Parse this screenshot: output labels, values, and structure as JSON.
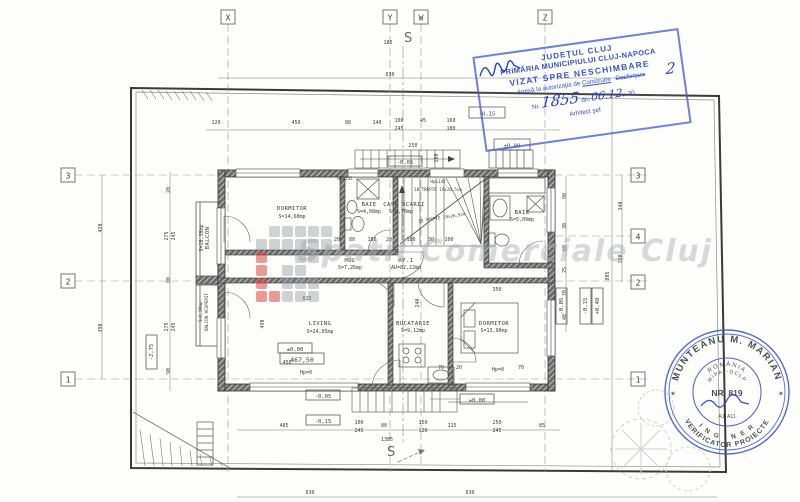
{
  "colors": {
    "ink": "#3c3c3c",
    "wall": "#2f2f2f",
    "stamp_blue": "#3b55c8",
    "watermark_grey": "#a8abaf",
    "watermark_red": "#d8483e",
    "grid_dash": "#9a9a9a"
  },
  "grid": {
    "top": [
      "X",
      "Y",
      "W",
      "Z"
    ],
    "left": [
      "3",
      "2",
      "1"
    ],
    "right": [
      "3",
      "4",
      "2",
      "1"
    ],
    "section_top": "S",
    "section_bottom": "S"
  },
  "rooms": {
    "dormitor1": {
      "name": "DORMITOR",
      "area": "S=14,60mp"
    },
    "baie1": {
      "name": "BAIE",
      "area": "S=4,08mp"
    },
    "casa_scarii": {
      "name": "CASA SCARII",
      "area": "S=8,70mp"
    },
    "baie2": {
      "name": "BAIE",
      "area": "S=5,09mp"
    },
    "hol": {
      "name": "HOL",
      "area": "S=7,26mp"
    },
    "ap1": {
      "name": "AP.1",
      "area": "AU=82,22mp"
    },
    "living": {
      "name": "LIVING",
      "area": "S=24,05mp"
    },
    "bucatarie": {
      "name": "BUCATARIE",
      "area": "S=9,12mp"
    },
    "dormitor2": {
      "name": "DORMITOR",
      "area": "S=13,90mp"
    },
    "balcon": {
      "name": "BALCON",
      "area": "S=10,38mp"
    },
    "balcon_acoperit": {
      "name": "BALCON ACOPERIT",
      "area": "S=6,30mp"
    }
  },
  "stairs": {
    "hp_parapet": "Hp=145",
    "hp": "Hp=145",
    "flight1": "18 TREPTE 19x26,5cm",
    "flight2": "18 TREPTE 19x26,5cm"
  },
  "levels": {
    "top_minus015": "-0,15",
    "top_minus005": "-0,05",
    "chimney": "±0,00",
    "living_level": "±0,00",
    "living_abs": "467,50",
    "bottom_minus005": "-0,05",
    "bottom_minus015": "-0,15",
    "bottom_zero": "±0,00",
    "right_a": "-0,05",
    "right_b": "-0,15",
    "right_c": "+0,40",
    "left_basement": "-2,75"
  },
  "dims": [
    {
      "x": 390,
      "y": 76,
      "t": "630"
    },
    {
      "x": 388,
      "y": 44,
      "t": "185"
    },
    {
      "x": 216,
      "y": 124,
      "t": "120"
    },
    {
      "x": 296,
      "y": 124,
      "t": "450"
    },
    {
      "x": 348,
      "y": 124,
      "t": "80"
    },
    {
      "x": 377,
      "y": 124,
      "t": "140"
    },
    {
      "x": 399,
      "y": 122,
      "t": "100"
    },
    {
      "x": 399,
      "y": 130,
      "t": "245"
    },
    {
      "x": 423,
      "y": 122,
      "t": "45"
    },
    {
      "x": 451,
      "y": 122,
      "t": "160"
    },
    {
      "x": 451,
      "y": 130,
      "t": "180"
    },
    {
      "x": 413,
      "y": 147,
      "t": "250"
    },
    {
      "x": 438,
      "y": 158,
      "t": "180",
      "r": -90
    },
    {
      "x": 337,
      "y": 241,
      "t": "20"
    },
    {
      "x": 352,
      "y": 241,
      "t": "80"
    },
    {
      "x": 372,
      "y": 241,
      "t": "180"
    },
    {
      "x": 389,
      "y": 241,
      "t": "20"
    },
    {
      "x": 411,
      "y": 241,
      "t": "180"
    },
    {
      "x": 431,
      "y": 241,
      "t": "30"
    },
    {
      "x": 449,
      "y": 241,
      "t": "100"
    },
    {
      "x": 307,
      "y": 300,
      "t": "615"
    },
    {
      "x": 287,
      "y": 364,
      "t": "450"
    },
    {
      "x": 264,
      "y": 324,
      "t": "490",
      "r": -90
    },
    {
      "x": 497,
      "y": 291,
      "t": "350"
    },
    {
      "x": 419,
      "y": 303,
      "t": "240",
      "r": -90
    },
    {
      "x": 306,
      "y": 374,
      "t": "Hp=0"
    },
    {
      "x": 498,
      "y": 371,
      "t": "Hp=0"
    },
    {
      "x": 441,
      "y": 369,
      "t": "70"
    },
    {
      "x": 459,
      "y": 369,
      "t": "20"
    },
    {
      "x": 521,
      "y": 369,
      "t": "70"
    },
    {
      "x": 284,
      "y": 427,
      "t": "485"
    },
    {
      "x": 359,
      "y": 424,
      "t": "100"
    },
    {
      "x": 359,
      "y": 432,
      "t": "245"
    },
    {
      "x": 384,
      "y": 427,
      "t": "80"
    },
    {
      "x": 423,
      "y": 424,
      "t": "150"
    },
    {
      "x": 423,
      "y": 432,
      "t": "120"
    },
    {
      "x": 452,
      "y": 427,
      "t": "115"
    },
    {
      "x": 497,
      "y": 424,
      "t": "250"
    },
    {
      "x": 497,
      "y": 432,
      "t": "245"
    },
    {
      "x": 542,
      "y": 427,
      "t": "85"
    },
    {
      "x": 387,
      "y": 441,
      "t": "1385"
    },
    {
      "x": 310,
      "y": 494,
      "t": "630"
    },
    {
      "x": 470,
      "y": 494,
      "t": "630"
    },
    {
      "x": 102,
      "y": 228,
      "t": "420",
      "r": -90
    },
    {
      "x": 102,
      "y": 328,
      "t": "390",
      "r": -90
    },
    {
      "x": 170,
      "y": 190,
      "t": "20",
      "r": -90
    },
    {
      "x": 168,
      "y": 236,
      "t": "275",
      "r": -90
    },
    {
      "x": 175,
      "y": 236,
      "t": "245",
      "r": -90
    },
    {
      "x": 170,
      "y": 280,
      "t": "80",
      "r": -90
    },
    {
      "x": 168,
      "y": 327,
      "t": "275",
      "r": -90
    },
    {
      "x": 175,
      "y": 327,
      "t": "245",
      "r": -90
    },
    {
      "x": 170,
      "y": 371,
      "t": "90",
      "r": -90
    },
    {
      "x": 566,
      "y": 196,
      "t": "90",
      "r": -90
    },
    {
      "x": 566,
      "y": 226,
      "t": "30",
      "r": -90
    },
    {
      "x": 566,
      "y": 248,
      "t": "60",
      "r": -90
    },
    {
      "x": 566,
      "y": 270,
      "t": "25",
      "r": -90
    },
    {
      "x": 566,
      "y": 293,
      "t": "70",
      "r": -90
    },
    {
      "x": 566,
      "y": 317,
      "t": "40",
      "r": -90
    },
    {
      "x": 622,
      "y": 206,
      "t": "340",
      "r": -90
    },
    {
      "x": 622,
      "y": 259,
      "t": "180",
      "r": -90
    },
    {
      "x": 609,
      "y": 276,
      "t": "805",
      "r": -90
    }
  ],
  "watermark": {
    "text": "Spatii Comerciale Cluj",
    "logo_rows": [
      ".ggggg",
      "gggggg",
      "r..gg.",
      "r.gg..",
      "r.ggg.",
      "rrggg."
    ]
  },
  "stamp_rect": {
    "line1": "JUDEŢUL CLUJ",
    "line2": "PRIMĂRIA MUNICIPIULUI CLUJ-NAPOCA",
    "line3": "VIZAT SPRE NESCHIMBARE",
    "line4": "Anexă la autorizaţia de",
    "line4b": "Construire",
    "line4c": "Desfiinţare",
    "nr_label": "Nr.",
    "nr_value": "1855",
    "din": "din",
    "date": "06.12.",
    "year": "20",
    "two": "2",
    "signer": "Arhitect şef"
  },
  "stamp_round": {
    "outer_top": "MUNTEANU M. MARIAN",
    "outer_bottom": "VERIFICATOR PROIECTE",
    "ring2": "I N G I N E R",
    "inner1": "ROMÂNIA",
    "inner2": "MIPAT-DCLP",
    "nr": "NR. 819",
    "cat": "A1, A11",
    "star_left": "✶",
    "star_right": "✶"
  }
}
